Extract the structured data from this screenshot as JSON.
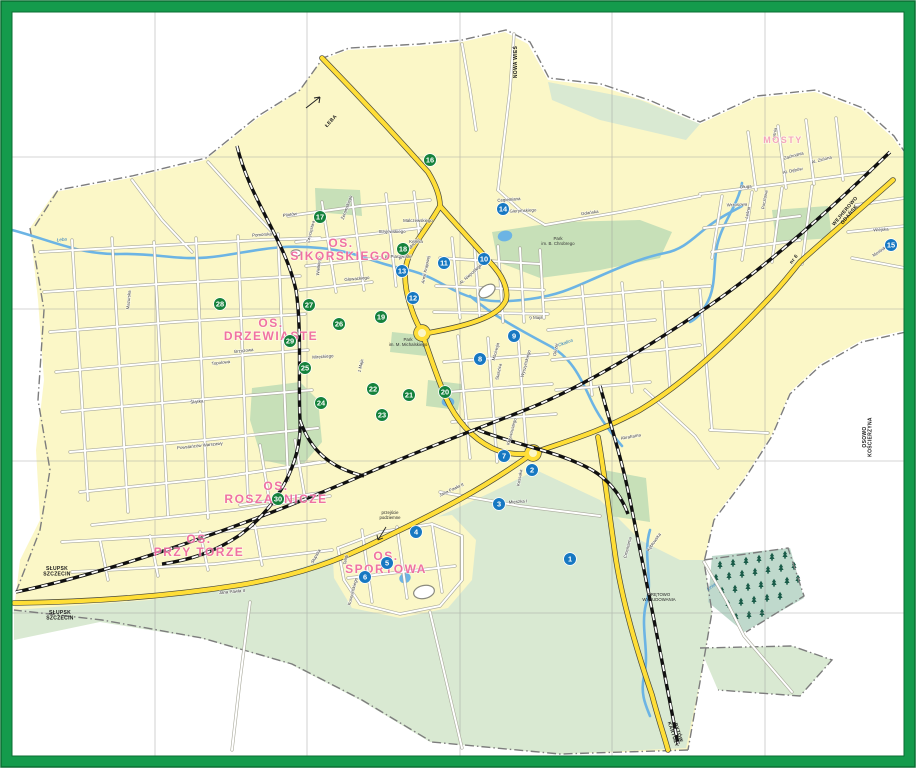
{
  "map": {
    "colors": {
      "frame_green": "#149B4C",
      "frame_dark": "#0A6E32",
      "city_fill": "#FBF7C7",
      "fields_fill": "#D9E9D2",
      "park_fill": "#C7E0B8",
      "forest_fill": "#BFD9CC",
      "tree_green": "#1A5C49",
      "water": "#6CB4E4",
      "road_casing": "#A9A99B",
      "road_fill": "#FFFFFF",
      "main_road": "#FFDE37",
      "main_road_casing": "#4A4A3A",
      "rail": "#111111",
      "boundary": "#7D7D7D",
      "grid": "#999999",
      "district_pink": "#F0679F",
      "district_pink_light": "#F5A0BE",
      "marker_blue": "#1778C2",
      "marker_green": "#15823C",
      "label_dark": "#3A3A3A",
      "dest_black": "#1A1A1A"
    },
    "districts": [
      {
        "lines": [
          "OS.",
          "SIKORSKIEGO"
        ],
        "x": 341,
        "y": 247,
        "size": 12,
        "tone": "district_pink"
      },
      {
        "lines": [
          "OS.",
          "DRZEWIASTE"
        ],
        "x": 271,
        "y": 327,
        "size": 12,
        "tone": "district_pink"
      },
      {
        "lines": [
          "OS.",
          "ROSZARNICZE"
        ],
        "x": 276,
        "y": 490,
        "size": 12,
        "tone": "district_pink"
      },
      {
        "lines": [
          "OS.",
          "PRZY TORZE"
        ],
        "x": 199,
        "y": 543,
        "size": 12,
        "tone": "district_pink"
      },
      {
        "lines": [
          "OS.",
          "SPORTOWA"
        ],
        "x": 386,
        "y": 560,
        "size": 12,
        "tone": "district_pink"
      },
      {
        "lines": [
          "MOSTY"
        ],
        "x": 783,
        "y": 143,
        "size": 9,
        "tone": "district_pink_light"
      }
    ],
    "markers": {
      "list": [
        {
          "n": "1",
          "x": 570,
          "y": 559,
          "c": "blue"
        },
        {
          "n": "2",
          "x": 532,
          "y": 470,
          "c": "blue"
        },
        {
          "n": "3",
          "x": 499,
          "y": 504,
          "c": "blue"
        },
        {
          "n": "4",
          "x": 416,
          "y": 532,
          "c": "blue"
        },
        {
          "n": "5",
          "x": 387,
          "y": 563,
          "c": "blue"
        },
        {
          "n": "6",
          "x": 365,
          "y": 577,
          "c": "blue"
        },
        {
          "n": "7",
          "x": 504,
          "y": 456,
          "c": "blue"
        },
        {
          "n": "8",
          "x": 480,
          "y": 359,
          "c": "blue"
        },
        {
          "n": "9",
          "x": 514,
          "y": 336,
          "c": "blue"
        },
        {
          "n": "10",
          "x": 484,
          "y": 259,
          "c": "blue"
        },
        {
          "n": "11",
          "x": 444,
          "y": 263,
          "c": "blue"
        },
        {
          "n": "12",
          "x": 413,
          "y": 298,
          "c": "blue"
        },
        {
          "n": "13",
          "x": 402,
          "y": 271,
          "c": "blue"
        },
        {
          "n": "14",
          "x": 503,
          "y": 209,
          "c": "blue"
        },
        {
          "n": "15",
          "x": 891,
          "y": 245,
          "c": "blue"
        },
        {
          "n": "16",
          "x": 430,
          "y": 160,
          "c": "green"
        },
        {
          "n": "17",
          "x": 320,
          "y": 217,
          "c": "green"
        },
        {
          "n": "18",
          "x": 403,
          "y": 249,
          "c": "green"
        },
        {
          "n": "19",
          "x": 381,
          "y": 317,
          "c": "green"
        },
        {
          "n": "20",
          "x": 445,
          "y": 392,
          "c": "green"
        },
        {
          "n": "21",
          "x": 409,
          "y": 395,
          "c": "green"
        },
        {
          "n": "22",
          "x": 373,
          "y": 389,
          "c": "green"
        },
        {
          "n": "23",
          "x": 382,
          "y": 415,
          "c": "green"
        },
        {
          "n": "24",
          "x": 321,
          "y": 403,
          "c": "green"
        },
        {
          "n": "25",
          "x": 305,
          "y": 368,
          "c": "green"
        },
        {
          "n": "26",
          "x": 339,
          "y": 324,
          "c": "green"
        },
        {
          "n": "27",
          "x": 309,
          "y": 305,
          "c": "green"
        },
        {
          "n": "28",
          "x": 220,
          "y": 304,
          "c": "green"
        },
        {
          "n": "29",
          "x": 290,
          "y": 341,
          "c": "green"
        },
        {
          "n": "30",
          "x": 278,
          "y": 499,
          "c": "green"
        }
      ]
    },
    "destinations": [
      {
        "lines": [
          "ŁEBA"
        ],
        "x": 332,
        "y": 122,
        "rot": -48
      },
      {
        "lines": [
          "SŁUPSK",
          "SZCZECIN"
        ],
        "x": 57,
        "y": 570,
        "rot": 0
      },
      {
        "lines": [
          "SŁUPSK",
          "SZCZECIN"
        ],
        "x": 60,
        "y": 614,
        "rot": 0
      },
      {
        "lines": [
          "WEJHEROWO",
          "GDAŃSK"
        ],
        "x": 846,
        "y": 212,
        "rot": -50
      },
      {
        "lines": [
          "BYTÓW",
          "KARTUZY"
        ],
        "x": 677,
        "y": 733,
        "rot": 72
      },
      {
        "lines": [
          "nr 6"
        ],
        "x": 795,
        "y": 260,
        "rot": -52
      },
      {
        "lines": [
          "NOWA WIEŚ"
        ],
        "x": 517,
        "y": 62,
        "rot": -90
      },
      {
        "lines": [
          "OSOWO",
          "KOŚCIERZYNA"
        ],
        "x": 866,
        "y": 437,
        "rot": -90
      }
    ],
    "streets": [
      {
        "t": "Pomorska",
        "x": 262,
        "y": 236,
        "r": -4
      },
      {
        "t": "Malczewskiego",
        "x": 418,
        "y": 222,
        "r": 0
      },
      {
        "t": "Stryjewskiego",
        "x": 392,
        "y": 233,
        "r": 0
      },
      {
        "t": "Kellera",
        "x": 416,
        "y": 243,
        "r": 0
      },
      {
        "t": "pl. Piastowski",
        "x": 398,
        "y": 258,
        "r": 0
      },
      {
        "t": "Głowackiego",
        "x": 357,
        "y": 280,
        "r": -5
      },
      {
        "t": "Wielkiego",
        "x": 320,
        "y": 266,
        "r": -85
      },
      {
        "t": "Żeromskiego",
        "x": 348,
        "y": 208,
        "r": -70
      },
      {
        "t": "Pilotów",
        "x": 290,
        "y": 216,
        "r": -8
      },
      {
        "t": "Zwycięstwa",
        "x": 312,
        "y": 232,
        "r": -75
      },
      {
        "t": "Brzozowa",
        "x": 244,
        "y": 352,
        "r": -6
      },
      {
        "t": "Topolowa",
        "x": 221,
        "y": 364,
        "r": -6
      },
      {
        "t": "Mireckiego",
        "x": 323,
        "y": 358,
        "r": -4
      },
      {
        "t": "1 Maja",
        "x": 362,
        "y": 366,
        "r": -78
      },
      {
        "t": "9 Maja",
        "x": 536,
        "y": 319,
        "r": -3
      },
      {
        "t": "Armii Krajowej",
        "x": 427,
        "y": 270,
        "r": -78
      },
      {
        "t": "Al. Niepodległości",
        "x": 474,
        "y": 273,
        "r": -42
      },
      {
        "t": "Aleja Wolności",
        "x": 410,
        "y": 250,
        "r": -46
      },
      {
        "t": "Gdańska",
        "x": 590,
        "y": 214,
        "r": -8
      },
      {
        "t": "Cegielniana",
        "x": 509,
        "y": 201,
        "r": -5
      },
      {
        "t": "Gierymskiego",
        "x": 523,
        "y": 212,
        "r": -3
      },
      {
        "t": "Okrzei",
        "x": 557,
        "y": 350,
        "r": -80
      },
      {
        "t": "Staszica",
        "x": 500,
        "y": 372,
        "r": -78
      },
      {
        "t": "Mściwoja",
        "x": 497,
        "y": 352,
        "r": -75
      },
      {
        "t": "Wyszyńskiego",
        "x": 527,
        "y": 364,
        "r": -75
      },
      {
        "t": "Mieszka I",
        "x": 518,
        "y": 503,
        "r": -4
      },
      {
        "t": "Kossaka",
        "x": 521,
        "y": 478,
        "r": -80
      },
      {
        "t": "Teligi",
        "x": 347,
        "y": 560,
        "r": -80
      },
      {
        "t": "Kusocińskiego",
        "x": 354,
        "y": 592,
        "r": -75
      },
      {
        "t": "Słupska",
        "x": 317,
        "y": 557,
        "r": -60
      },
      {
        "t": "Krzywoustego",
        "x": 513,
        "y": 432,
        "r": -75
      },
      {
        "t": "Abrahama",
        "x": 631,
        "y": 438,
        "r": -10
      },
      {
        "t": "Długa",
        "x": 746,
        "y": 188,
        "r": -4
      },
      {
        "t": "Letnia",
        "x": 776,
        "y": 134,
        "r": -80
      },
      {
        "t": "Zachodnia",
        "x": 794,
        "y": 157,
        "r": -15
      },
      {
        "t": "Al. Dębów",
        "x": 793,
        "y": 172,
        "r": -12
      },
      {
        "t": "Al. Zielona",
        "x": 822,
        "y": 161,
        "r": -15
      },
      {
        "t": "Wrzosowa",
        "x": 737,
        "y": 206,
        "r": -3
      },
      {
        "t": "Pocztowa",
        "x": 766,
        "y": 200,
        "r": -80
      },
      {
        "t": "Leśna",
        "x": 749,
        "y": 213,
        "r": -78
      },
      {
        "t": "Wiejska",
        "x": 881,
        "y": 231,
        "r": -4
      },
      {
        "t": "Mostnika",
        "x": 881,
        "y": 252,
        "r": -35
      },
      {
        "t": "Kębłowska",
        "x": 655,
        "y": 543,
        "r": -55
      },
      {
        "t": "Cmentarna",
        "x": 629,
        "y": 548,
        "r": -75
      },
      {
        "t": "Śląska",
        "x": 197,
        "y": 403,
        "r": -6
      },
      {
        "t": "Powstańców Warszawy",
        "x": 200,
        "y": 447,
        "r": -6
      },
      {
        "t": "Mazurska",
        "x": 130,
        "y": 300,
        "r": -85
      },
      {
        "t": "Jana Pawła II",
        "x": 452,
        "y": 491,
        "r": -25
      },
      {
        "t": "Jana Pawła II",
        "x": 232,
        "y": 593,
        "r": -5
      }
    ],
    "parks": [
      {
        "lines": [
          "Park",
          "im. B. Chrobrego"
        ],
        "x": 558,
        "y": 240
      },
      {
        "lines": [
          "Park",
          "im. M. Michalskiego"
        ],
        "x": 408,
        "y": 341
      }
    ],
    "waters": [
      {
        "t": "Łeba",
        "x": 62,
        "y": 241,
        "r": -6
      },
      {
        "t": "Okalica",
        "x": 566,
        "y": 344,
        "r": -20
      },
      {
        "t": "Linia",
        "x": 712,
        "y": 588,
        "r": -35
      }
    ],
    "notes": [
      {
        "lines": [
          "przejście",
          "podziemne"
        ],
        "x": 390,
        "y": 514
      },
      {
        "lines": [
          "DRĘTOWO",
          "WYBUDOWANIA"
        ],
        "x": 659,
        "y": 596
      }
    ]
  }
}
